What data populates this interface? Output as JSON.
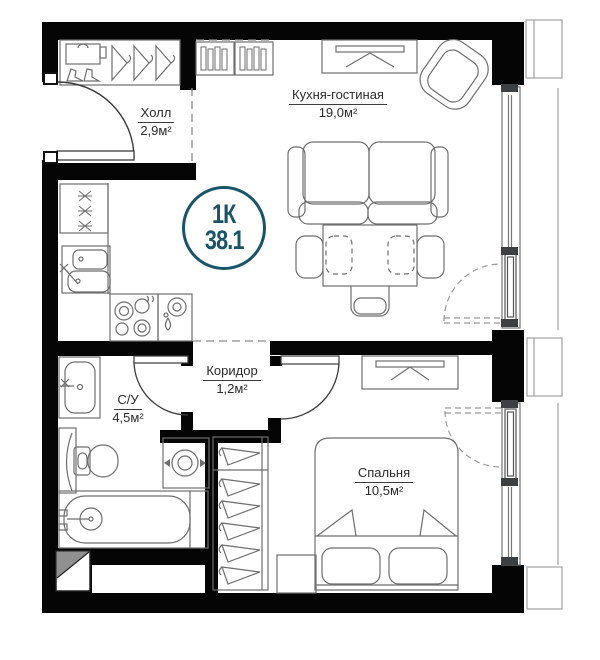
{
  "plan": {
    "badge": {
      "type": "1К",
      "area": "38.1"
    },
    "rooms": {
      "hall": {
        "name": "Холл",
        "area": "2,9м²"
      },
      "kitchen": {
        "name": "Кухня-гостиная",
        "area": "19,0м²"
      },
      "corridor": {
        "name": "Коридор",
        "area": "1,2м²"
      },
      "bathroom": {
        "name": "С/У",
        "area": "4,5м²"
      },
      "bedroom": {
        "name": "Спальня",
        "area": "10,5м²"
      }
    },
    "colors": {
      "wall": "#050505",
      "badge_accent": "#195568",
      "furniture_line": "#6e6e6e",
      "text": "#2b2b2b"
    }
  }
}
